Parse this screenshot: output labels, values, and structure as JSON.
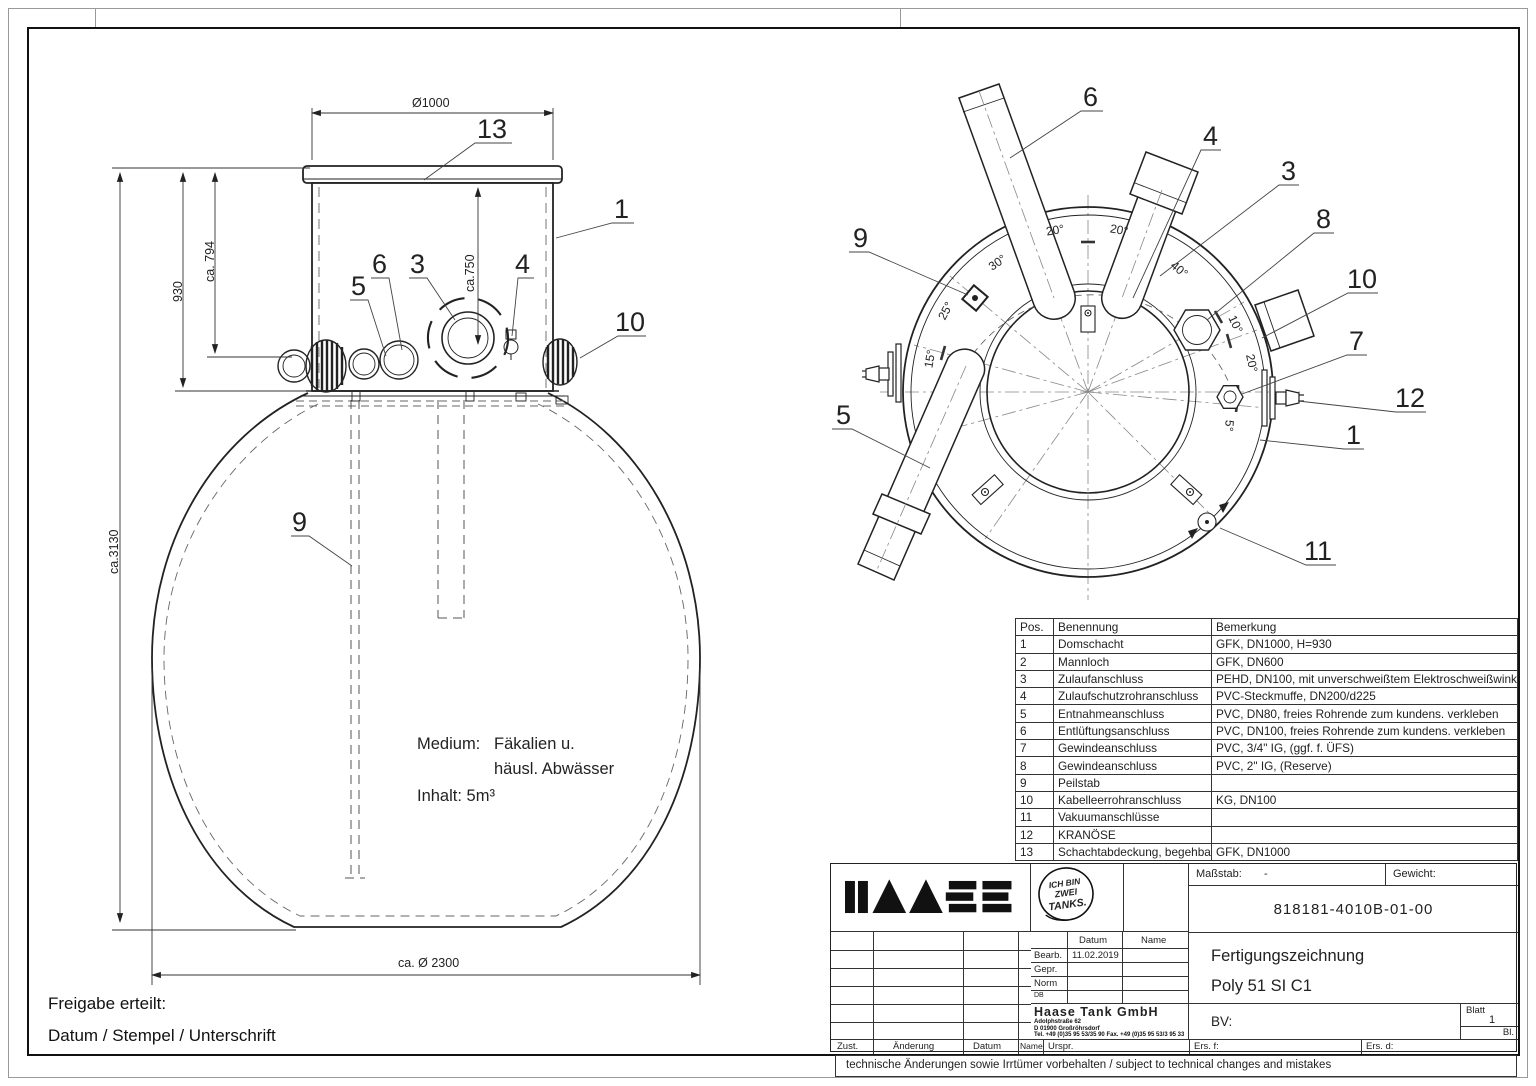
{
  "frame": {
    "disclaimer": "technische Änderungen sowie Irrtümer vorbehalten / subject to technical changes and mistakes"
  },
  "approval": {
    "line1": "Freigabe erteilt:",
    "line2": "Datum / Stempel / Unterschrift"
  },
  "front_view": {
    "dims": {
      "top_diameter": "Ø1000",
      "height_total": "ca.3130",
      "height_shaft": "930",
      "height_794": "ca. 794",
      "height_750": "ca.750",
      "bottom_diameter": "ca. Ø 2300"
    },
    "notes": {
      "medium_label": "Medium:",
      "medium_value1": "Fäkalien u.",
      "medium_value2": "häusl. Abwässer",
      "inhalt": "Inhalt: 5m³"
    },
    "callouts": [
      "13",
      "1",
      "5",
      "6",
      "3",
      "4",
      "10",
      "9"
    ]
  },
  "top_view": {
    "callouts": [
      "6",
      "4",
      "3",
      "8",
      "10",
      "7",
      "12",
      "1",
      "9",
      "5",
      "11"
    ],
    "angles": [
      "20°",
      "20°",
      "30°",
      "40°",
      "25°",
      "15°",
      "10°",
      "20°",
      "5°"
    ]
  },
  "parts_table": {
    "headers": [
      "Pos.",
      "Benennung",
      "Bemerkung"
    ],
    "rows": [
      {
        "pos": "1",
        "name": "Domschacht",
        "note": "GFK, DN1000, H=930"
      },
      {
        "pos": "2",
        "name": "Mannloch",
        "note": "GFK, DN600"
      },
      {
        "pos": "3",
        "name": "Zulaufanschluss",
        "note": "PEHD, DN100, mit unverschweißtem Elektroschweißwinkel"
      },
      {
        "pos": "4",
        "name": "Zulaufschutzrohranschluss",
        "note": "PVC-Steckmuffe, DN200/d225"
      },
      {
        "pos": "5",
        "name": "Entnahmeanschluss",
        "note": "PVC, DN80, freies Rohrende zum kundens. verkleben"
      },
      {
        "pos": "6",
        "name": "Entlüftungsanschluss",
        "note": "PVC, DN100, freies Rohrende zum kundens. verkleben"
      },
      {
        "pos": "7",
        "name": "Gewindeanschluss",
        "note": "PVC, 3/4\" IG, (ggf. f. ÜFS)"
      },
      {
        "pos": "8",
        "name": "Gewindeanschluss",
        "note": "PVC, 2\" IG, (Reserve)"
      },
      {
        "pos": "9",
        "name": "Peilstab",
        "note": ""
      },
      {
        "pos": "10",
        "name": "Kabelleerrohranschluss",
        "note": "KG, DN100"
      },
      {
        "pos": "11",
        "name": "Vakuumanschlüsse",
        "note": ""
      },
      {
        "pos": "12",
        "name": "KRANÖSE",
        "note": ""
      },
      {
        "pos": "13",
        "name": "Schachtabdeckung, begehbar",
        "note": "GFK, DN1000"
      }
    ]
  },
  "title_block": {
    "stamp": [
      "ICH BIN",
      "ZWEI",
      "TANKS."
    ],
    "masstab_label": "Maßstab:",
    "masstab_value": "-",
    "gewicht_label": "Gewicht:",
    "drawing_number": "818181-4010B-01-00",
    "col_datum": "Datum",
    "col_name": "Name",
    "row_bearb": "Bearb.",
    "bearb_date": "11.02.2019",
    "row_gepr": "Gepr.",
    "row_norm": "Norm",
    "row_db": "DB",
    "company": "Haase Tank GmbH",
    "address1": "Adolphstraße 62",
    "address2": "D 01900 Großröhrsdorf",
    "address3": "Tel. +49 (0)35 95 53/35 90    Fax. +49 (0)35 95 53/3 95 33",
    "address4": "www.haasetank.de",
    "doc_type": "Fertigungszeichnung",
    "doc_title": "Poly 51 SI C1",
    "bv_label": "BV:",
    "blatt_label": "Blatt",
    "blatt_value": "1",
    "bl_label": "Bl.",
    "bottom_labels": [
      "Zust.",
      "Änderung",
      "Datum",
      "Name",
      "Urspr.",
      "Ers. f:",
      "Ers. d:"
    ]
  }
}
